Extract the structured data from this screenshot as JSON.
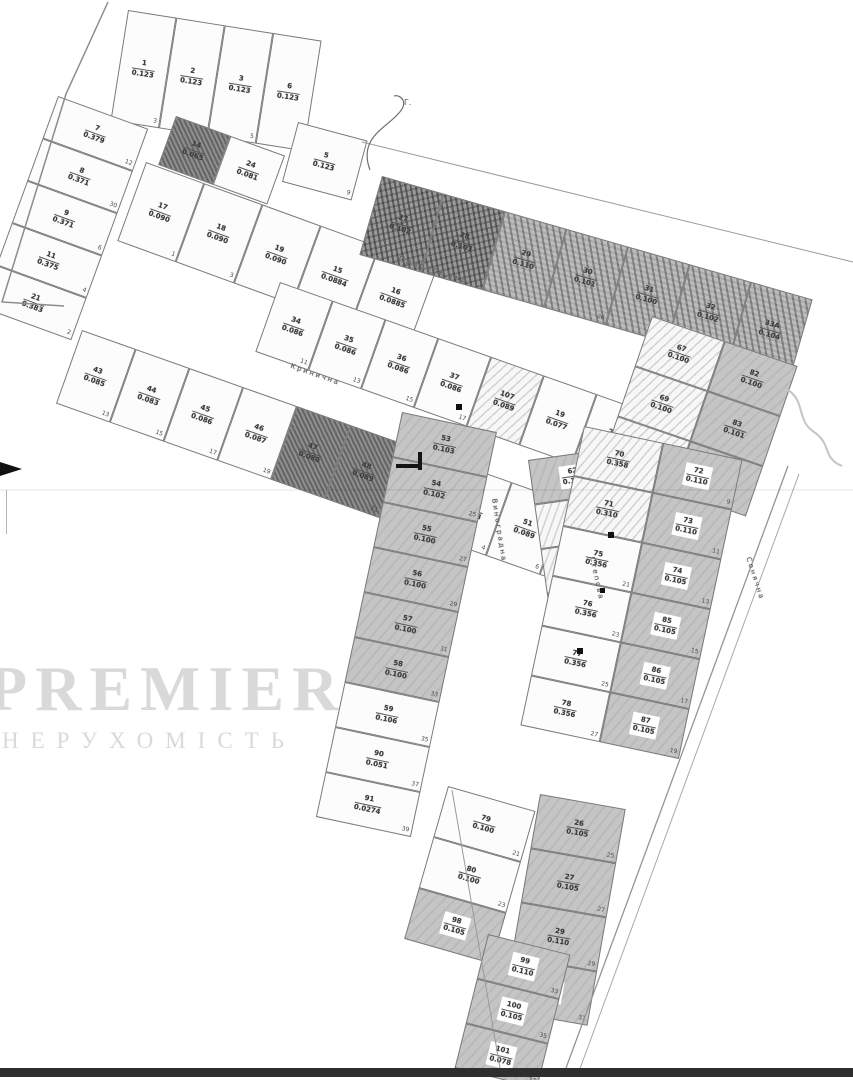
{
  "watermark": {
    "line1": "PREMIER",
    "line2": "НЕРУХОМІСТЬ"
  },
  "annotation": "Г.",
  "streets": [
    "Прибережна",
    "Кринична",
    "Виноградна",
    "Степова",
    "Сонячна"
  ],
  "blocks": [
    {
      "id": "b1",
      "cells": [
        {
          "n": "1",
          "a": "0.123",
          "s": "3"
        },
        {
          "n": "2",
          "a": "0.123",
          "s": "5"
        },
        {
          "n": "3",
          "a": "0.123",
          "s": "5"
        },
        {
          "n": "6",
          "a": "0.123",
          "s": "9"
        }
      ]
    },
    {
      "id": "b2",
      "cells": [
        {
          "n": "7",
          "a": "0.379",
          "s": "12"
        },
        {
          "n": "8",
          "a": "0.371",
          "s": "30"
        },
        {
          "n": "9",
          "a": "0.371",
          "s": "6"
        },
        {
          "n": "11",
          "a": "0.375",
          "s": "4"
        },
        {
          "n": "21",
          "a": "0.383",
          "s": "2"
        }
      ]
    },
    {
      "id": "b3",
      "cells": [
        {
          "n": "14",
          "a": "0.065",
          "f": "darksolid"
        },
        {
          "n": "24",
          "a": "0.081"
        }
      ]
    },
    {
      "id": "b5",
      "cells": [
        {
          "n": "5",
          "a": "0.123",
          "s": "9"
        }
      ]
    },
    {
      "id": "b4",
      "cells": [
        {
          "n": "17",
          "a": "0.090",
          "s": "1"
        },
        {
          "n": "18",
          "a": "0.090",
          "s": "3"
        },
        {
          "n": "19",
          "a": "0.090",
          "s": "5"
        },
        {
          "n": "15",
          "a": "0.0884",
          "s": "6"
        },
        {
          "n": "16",
          "a": "0.0885",
          "s": "8"
        }
      ]
    },
    {
      "id": "b6",
      "cells": [
        {
          "n": "27",
          "a": "0.102",
          "f": "dark"
        },
        {
          "n": "28",
          "a": "0.103",
          "f": "dark"
        },
        {
          "n": "29",
          "a": "0.110",
          "f": "darkhatch"
        },
        {
          "n": "30",
          "a": "0.101",
          "f": "darkhatch",
          "s": "26"
        },
        {
          "n": "31",
          "a": "0.100",
          "f": "darkhatch",
          "s": "28"
        },
        {
          "n": "32",
          "a": "0.102",
          "f": "darkhatch",
          "s": "30"
        },
        {
          "n": "33А",
          "a": "0.104",
          "f": "darkhatch"
        }
      ]
    },
    {
      "id": "b7",
      "cells": [
        {
          "n": "34",
          "a": "0.086",
          "s": "11"
        },
        {
          "n": "35",
          "a": "0.086",
          "s": "13"
        },
        {
          "n": "36",
          "a": "0.086",
          "s": "15"
        },
        {
          "n": "37",
          "a": "0.086",
          "s": "17"
        },
        {
          "n": "107",
          "a": "0.089",
          "f": "hatch"
        },
        {
          "n": "19",
          "a": "0.077"
        },
        {
          "n": "21",
          "a": "0.073"
        },
        {
          "n": "25",
          "a": "0.096",
          "f": "dark"
        }
      ]
    },
    {
      "id": "b8",
      "cells": [
        {
          "n": "43",
          "a": "0.085",
          "s": "13"
        },
        {
          "n": "44",
          "a": "0.083",
          "s": "15"
        },
        {
          "n": "45",
          "a": "0.086",
          "s": "17"
        },
        {
          "n": "46",
          "a": "0.087",
          "s": "19"
        },
        {
          "n": "47",
          "a": "0.080",
          "f": "darksolid"
        },
        {
          "n": "48",
          "a": "0.089",
          "f": "darksolid",
          "s": "21"
        },
        {
          "n": "49",
          "a": "0.094",
          "s": "2"
        },
        {
          "n": "50",
          "a": "0.098",
          "s": "4"
        },
        {
          "n": "51",
          "a": "0.089",
          "s": "6"
        },
        {
          "n": "52",
          "a": "0.092",
          "s": "8"
        }
      ]
    },
    {
      "id": "b9",
      "cells": [
        {
          "n": "67",
          "a": "0.100",
          "f": "hatch"
        },
        {
          "n": "82",
          "a": "0.100",
          "f": "gray"
        },
        {
          "n": "69",
          "a": "0.100",
          "f": "hatch"
        },
        {
          "n": "83",
          "a": "0.101",
          "f": "gray"
        },
        {
          "n": "68",
          "a": "0.106",
          "f": "hatch"
        },
        {
          "n": "84",
          "a": "0.100",
          "f": "gray"
        }
      ]
    },
    {
      "id": "b10",
      "cells": [
        {
          "n": "53",
          "a": "0.103",
          "f": "gray"
        },
        {
          "n": "54",
          "a": "0.102",
          "f": "gray",
          "s": "25"
        },
        {
          "n": "55",
          "a": "0.100",
          "f": "gray",
          "s": "27"
        },
        {
          "n": "56",
          "a": "0.100",
          "f": "gray",
          "s": "29"
        },
        {
          "n": "57",
          "a": "0.100",
          "f": "gray",
          "s": "31"
        },
        {
          "n": "58",
          "a": "0.100",
          "f": "gray",
          "s": "33"
        },
        {
          "n": "59",
          "a": "0.106",
          "s": "35"
        },
        {
          "n": "90",
          "a": "0.051",
          "s": "37"
        },
        {
          "n": "91",
          "a": "0.0274",
          "s": "39"
        }
      ]
    },
    {
      "id": "b11",
      "cells": [
        {
          "n": "62",
          "a": "0.100",
          "f": "gray",
          "box": true
        },
        {
          "n": "63",
          "a": "0.093",
          "f": "hatch"
        },
        {
          "n": "64",
          "a": "0.085",
          "f": "hatch"
        },
        {
          "n": "65",
          "a": "0.085",
          "f": "hatch"
        },
        {
          "n": "66",
          "a": "0.085",
          "f": "hatch",
          "s": "18"
        }
      ]
    },
    {
      "id": "b12",
      "cells": [
        {
          "n": "70",
          "a": "0.358",
          "f": "hatch"
        },
        {
          "n": "72",
          "a": "0.110",
          "f": "gray",
          "box": true,
          "s": "9"
        },
        {
          "n": "71",
          "a": "0.310",
          "f": "hatch"
        },
        {
          "n": "73",
          "a": "0.110",
          "f": "gray",
          "box": true,
          "s": "11"
        },
        {
          "n": "75",
          "a": "0.356",
          "s": "21"
        },
        {
          "n": "74",
          "a": "0.105",
          "f": "gray",
          "box": true,
          "s": "13"
        },
        {
          "n": "76",
          "a": "0.356",
          "s": "23"
        },
        {
          "n": "85",
          "a": "0.105",
          "f": "gray",
          "box": true,
          "s": "15"
        },
        {
          "n": "77",
          "a": "0.356",
          "s": "25"
        },
        {
          "n": "86",
          "a": "0.105",
          "f": "gray",
          "box": true,
          "s": "17"
        },
        {
          "n": "78",
          "a": "0.356",
          "s": "27"
        },
        {
          "n": "87",
          "a": "0.105",
          "f": "gray",
          "box": true,
          "s": "19"
        }
      ]
    },
    {
      "id": "b13",
      "cells": [
        {
          "n": "79",
          "a": "0.100",
          "s": "21"
        },
        {
          "n": "80",
          "a": "0.100",
          "s": "23"
        },
        {
          "n": "98",
          "a": "0.105",
          "f": "gray",
          "box": true
        }
      ]
    },
    {
      "id": "b14",
      "cells": [
        {
          "n": "26",
          "a": "0.105",
          "f": "gray",
          "s": "25"
        },
        {
          "n": "27",
          "a": "0.105",
          "f": "gray",
          "s": "27"
        },
        {
          "n": "29",
          "a": "0.110",
          "f": "gray",
          "s": "29"
        },
        {
          "n": "31",
          "a": "0.100",
          "f": "gray",
          "box": true,
          "s": "31"
        }
      ]
    },
    {
      "id": "b15",
      "cells": [
        {
          "n": "99",
          "a": "0.110",
          "f": "gray",
          "box": true,
          "s": "33"
        },
        {
          "n": "100",
          "a": "0.105",
          "f": "gray",
          "box": true,
          "s": "35"
        },
        {
          "n": "101",
          "a": "0.078",
          "f": "gray",
          "box": true,
          "s": "37"
        }
      ]
    }
  ]
}
